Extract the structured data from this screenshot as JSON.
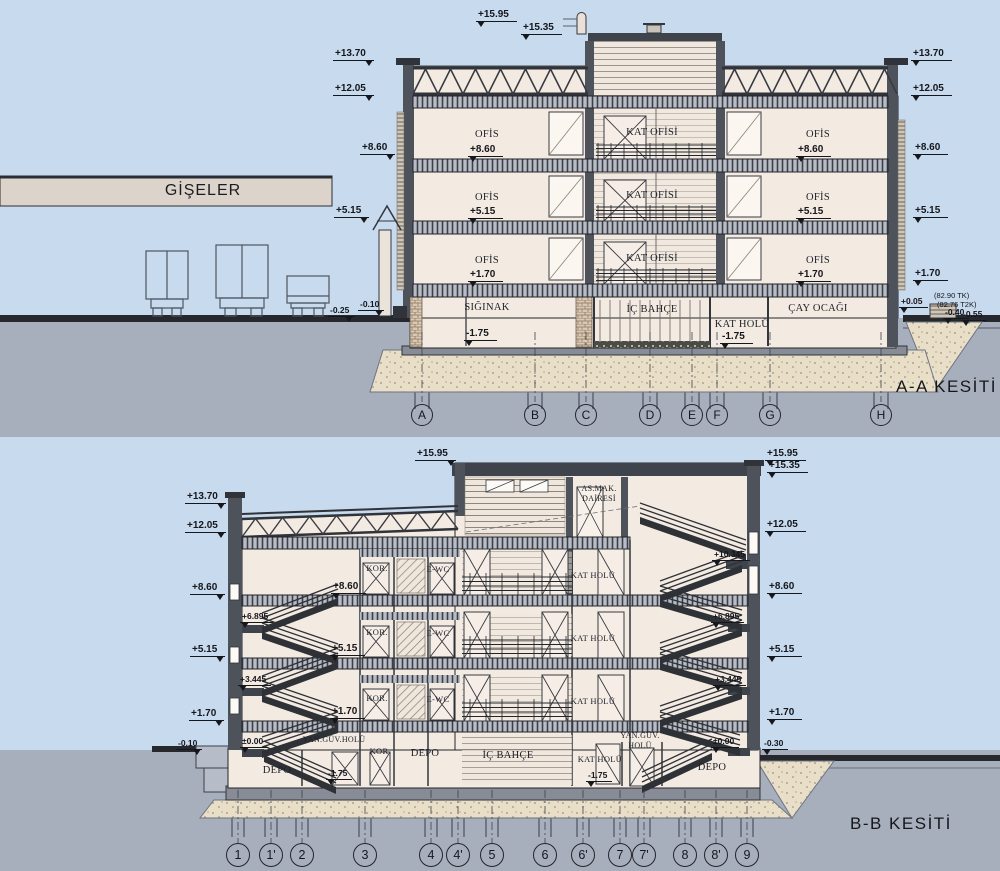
{
  "aa": {
    "title": "A-A KESİTİ",
    "canopy": "GİŞELER",
    "elev": {
      "p1595": "+15.95",
      "p1535": "+15.35",
      "p1370": "+13.70",
      "p1205": "+12.05",
      "p860": "+8.60",
      "p515": "+5.15",
      "p170": "+1.70",
      "m025": "-0.25",
      "m010": "-0.10",
      "p005": "+0.05",
      "m040": "-0.40",
      "m055": "-0.55",
      "m175": "-1.75"
    },
    "notes": {
      "tk": "(82.90 TK)",
      "t2k": "(82.76 T2K)"
    },
    "rooms": {
      "ofis": "OFİS",
      "kat_ofisi": "KAT OFİSİ",
      "siginak": "SIĞINAK",
      "ic_bahce": "İÇ BAHÇE",
      "kat_holu": "KAT HOLÜ",
      "cay_ocagi": "ÇAY OCAĞI"
    },
    "grid": [
      "A",
      "B",
      "C",
      "D",
      "E",
      "F",
      "G",
      "H"
    ]
  },
  "bb": {
    "title": "B-B KESİTİ",
    "elev": {
      "p1595": "+15.95",
      "p1535": "+15.35",
      "p1370": "+13.70",
      "p1205": "+12.05",
      "p10345": "+10.345",
      "p860": "+8.60",
      "p6895": "+6.895",
      "p515": "+5.15",
      "p3445": "+3.445",
      "p170": "+1.70",
      "z000": "±0.00",
      "m010": "-0.10",
      "m030": "-0.30",
      "m175": "-1.75"
    },
    "rooms": {
      "kor": "KOR.",
      "ewc": "E-WC",
      "kat_holu": "KAT HOLÜ",
      "asmak1": "AS.MAK.",
      "asmak2": "DAİRESİ",
      "depo": "DEPO",
      "yan_guv_holu": "YAN.GÜV.HOLÜ",
      "yan_guv": "YAN.GÜV.",
      "holu": "HOLÜ",
      "kor2": "KOR",
      "ic_bahce": "İÇ BAHÇE"
    },
    "grid": [
      "1",
      "1'",
      "2",
      "3",
      "4",
      "4'",
      "5",
      "6",
      "6'",
      "7",
      "7'",
      "8",
      "8'",
      "9"
    ]
  }
}
